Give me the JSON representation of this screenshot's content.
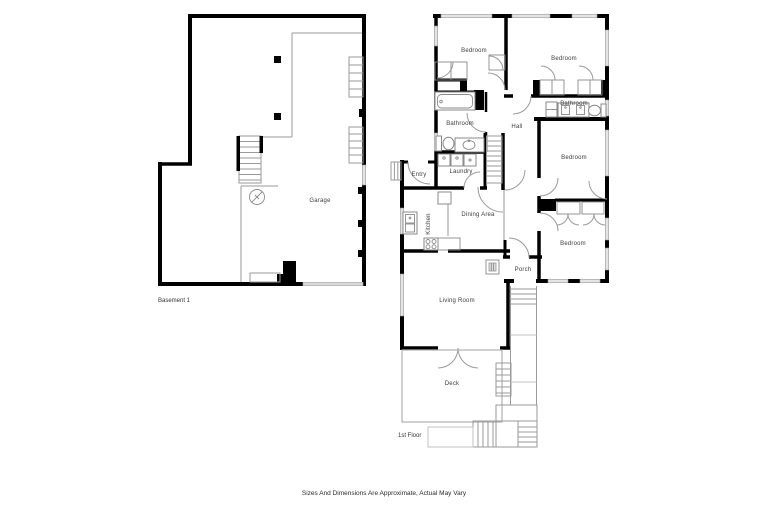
{
  "disclaimer": "Sizes And Dimensions Are Approximate, Actual May Vary",
  "basement": {
    "floor_label": "Basement 1",
    "rooms": [
      {
        "label": "Garage"
      }
    ]
  },
  "first_floor": {
    "floor_label": "1st Floor",
    "rooms": [
      {
        "label": "Bedroom"
      },
      {
        "label": "Bedroom"
      },
      {
        "label": "Bathroom"
      },
      {
        "label": "Bathroom"
      },
      {
        "label": "Hall"
      },
      {
        "label": "Laundry"
      },
      {
        "label": "Entry"
      },
      {
        "label": "Kitchen"
      },
      {
        "label": "Dining Area"
      },
      {
        "label": "Bedroom"
      },
      {
        "label": "Bedroom"
      },
      {
        "label": "Living Room"
      },
      {
        "label": "Porch"
      },
      {
        "label": "Deck"
      }
    ]
  },
  "colors": {
    "wall": "#000000",
    "thin_line": "#9a9a9a",
    "window_fill": "#e4e4e4",
    "text": "#3c3c3c",
    "background": "#ffffff"
  }
}
